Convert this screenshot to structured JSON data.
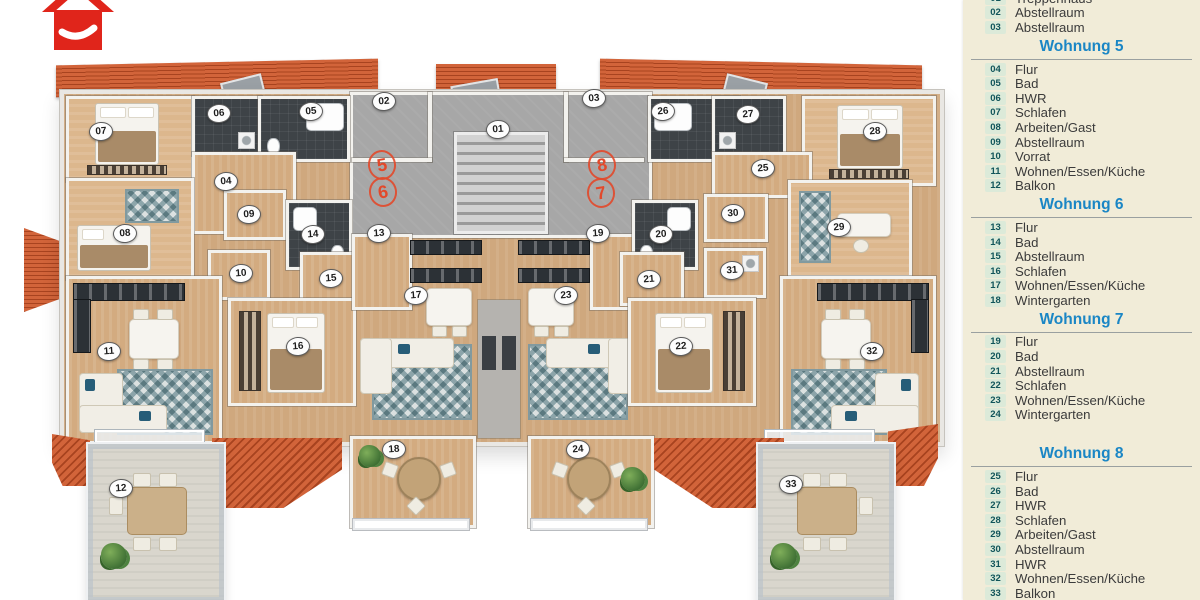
{
  "logo": {
    "label": "red-house-logo"
  },
  "legend": {
    "sections": [
      {
        "heading": null,
        "rows": [
          {
            "n": "01",
            "label": "Treppenhaus"
          },
          {
            "n": "02",
            "label": "Abstellraum"
          },
          {
            "n": "03",
            "label": "Abstellraum"
          }
        ]
      },
      {
        "heading": "Wohnung 5",
        "rows": [
          {
            "n": "04",
            "label": "Flur"
          },
          {
            "n": "05",
            "label": "Bad"
          },
          {
            "n": "06",
            "label": "HWR"
          },
          {
            "n": "07",
            "label": "Schlafen"
          },
          {
            "n": "08",
            "label": "Arbeiten/Gast"
          },
          {
            "n": "09",
            "label": "Abstellraum"
          },
          {
            "n": "10",
            "label": "Vorrat"
          },
          {
            "n": "11",
            "label": "Wohnen/Essen/Küche"
          },
          {
            "n": "12",
            "label": "Balkon"
          }
        ]
      },
      {
        "heading": "Wohnung 6",
        "rows": [
          {
            "n": "13",
            "label": "Flur"
          },
          {
            "n": "14",
            "label": "Bad"
          },
          {
            "n": "15",
            "label": "Abstellraum"
          },
          {
            "n": "16",
            "label": "Schlafen"
          },
          {
            "n": "17",
            "label": "Wohnen/Essen/Küche"
          },
          {
            "n": "18",
            "label": "Wintergarten"
          }
        ]
      },
      {
        "heading": "Wohnung 7",
        "rows": [
          {
            "n": "19",
            "label": "Flur"
          },
          {
            "n": "20",
            "label": "Bad"
          },
          {
            "n": "21",
            "label": "Abstellraum"
          },
          {
            "n": "22",
            "label": "Schlafen"
          },
          {
            "n": "23",
            "label": "Wohnen/Essen/Küche"
          },
          {
            "n": "24",
            "label": "Wintergarten"
          }
        ]
      },
      {
        "heading": "Wohnung 8",
        "gap_before": true,
        "rows": [
          {
            "n": "25",
            "label": "Flur"
          },
          {
            "n": "26",
            "label": "Bad"
          },
          {
            "n": "27",
            "label": "HWR"
          },
          {
            "n": "28",
            "label": "Schlafen"
          },
          {
            "n": "29",
            "label": "Arbeiten/Gast"
          },
          {
            "n": "30",
            "label": "Abstellraum"
          },
          {
            "n": "31",
            "label": "HWR"
          },
          {
            "n": "32",
            "label": "Wohnen/Essen/Küche"
          },
          {
            "n": "33",
            "label": "Balkon"
          }
        ]
      }
    ]
  },
  "plan": {
    "markers": [
      {
        "n": "01",
        "x": 497,
        "y": 128
      },
      {
        "n": "02",
        "x": 383,
        "y": 100
      },
      {
        "n": "03",
        "x": 593,
        "y": 97
      },
      {
        "n": "04",
        "x": 225,
        "y": 180
      },
      {
        "n": "05",
        "x": 310,
        "y": 110
      },
      {
        "n": "06",
        "x": 218,
        "y": 112
      },
      {
        "n": "07",
        "x": 100,
        "y": 130
      },
      {
        "n": "08",
        "x": 124,
        "y": 232
      },
      {
        "n": "09",
        "x": 248,
        "y": 213
      },
      {
        "n": "10",
        "x": 240,
        "y": 272
      },
      {
        "n": "11",
        "x": 108,
        "y": 350
      },
      {
        "n": "12",
        "x": 120,
        "y": 487
      },
      {
        "n": "13",
        "x": 378,
        "y": 232
      },
      {
        "n": "14",
        "x": 312,
        "y": 233
      },
      {
        "n": "15",
        "x": 330,
        "y": 277
      },
      {
        "n": "16",
        "x": 297,
        "y": 345
      },
      {
        "n": "17",
        "x": 415,
        "y": 294
      },
      {
        "n": "18",
        "x": 393,
        "y": 448
      },
      {
        "n": "19",
        "x": 597,
        "y": 232
      },
      {
        "n": "20",
        "x": 660,
        "y": 233
      },
      {
        "n": "21",
        "x": 648,
        "y": 278
      },
      {
        "n": "22",
        "x": 680,
        "y": 345
      },
      {
        "n": "23",
        "x": 565,
        "y": 294
      },
      {
        "n": "24",
        "x": 577,
        "y": 448
      },
      {
        "n": "25",
        "x": 762,
        "y": 167
      },
      {
        "n": "26",
        "x": 662,
        "y": 110
      },
      {
        "n": "27",
        "x": 747,
        "y": 113
      },
      {
        "n": "28",
        "x": 874,
        "y": 130
      },
      {
        "n": "29",
        "x": 838,
        "y": 226
      },
      {
        "n": "30",
        "x": 732,
        "y": 212
      },
      {
        "n": "31",
        "x": 731,
        "y": 269
      },
      {
        "n": "32",
        "x": 871,
        "y": 350
      },
      {
        "n": "33",
        "x": 790,
        "y": 483
      }
    ],
    "unit_numbers": [
      {
        "n": "5",
        "x": 380,
        "y": 163
      },
      {
        "n": "6",
        "x": 381,
        "y": 190
      },
      {
        "n": "8",
        "x": 600,
        "y": 163
      },
      {
        "n": "7",
        "x": 599,
        "y": 191
      }
    ],
    "colors": {
      "roof": "#c65a2e",
      "wood": "#cfa87e",
      "dark_tile": "#3e4347",
      "stair_floor": "#a7a7a7",
      "balcony_floor": "#d9d6cd",
      "accent_red": "#e2492b",
      "legend_bg": "#f1ecd8",
      "heading_blue": "#1a86c5"
    }
  }
}
